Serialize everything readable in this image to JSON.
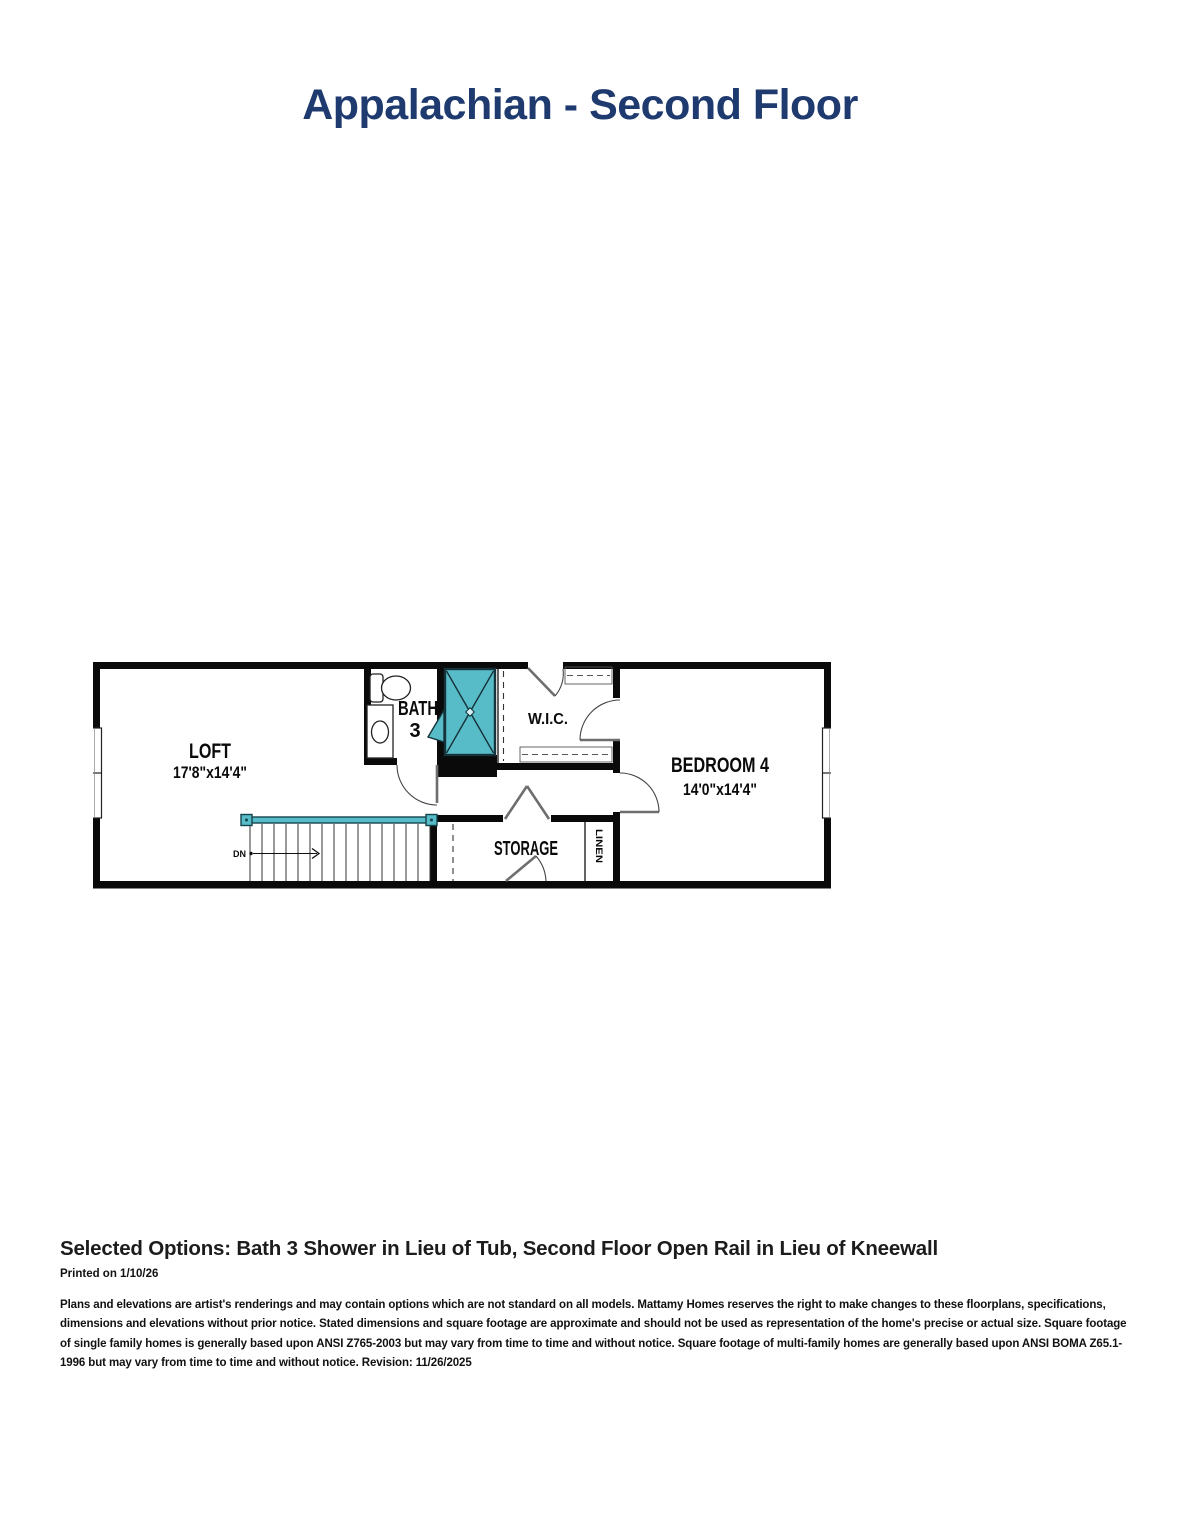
{
  "page": {
    "title": "Appalachian - Second Floor"
  },
  "plan": {
    "rooms": {
      "loft": {
        "name": "LOFT",
        "dims": "17'8\"x14'4\""
      },
      "bedroom4": {
        "name": "BEDROOM 4",
        "dims": "14'0\"x14'4\""
      },
      "bath": {
        "name": "BATH",
        "number": "3"
      },
      "wic": {
        "name": "W.I.C."
      },
      "storage": {
        "name": "STORAGE"
      },
      "linen": {
        "name": "LINEN"
      }
    },
    "stairs": {
      "direction_label": "DN"
    }
  },
  "footer": {
    "selected_options": "Selected Options: Bath 3 Shower in Lieu of Tub, Second Floor Open Rail in Lieu of Kneewall",
    "printed_on": "Printed on 1/10/26",
    "disclaimer": "Plans and elevations are artist's renderings and may contain options which are not standard on all models. Mattamy Homes reserves the right to make changes to these floorplans, specifications, dimensions and elevations without prior notice. Stated dimensions and square footage are approximate and should not be used as representation of the home's precise or actual size. Square footage of single family homes is generally based upon ANSI Z765-2003 but may vary from time to time and without notice. Square footage of multi-family homes are generally based upon ANSI BOMA Z65.1-1996 but may vary from time to time and without notice. Revision: 11/26/2025"
  },
  "colors": {
    "title_navy": "#1e3a6e",
    "fixture_teal": "#58bcc8",
    "wall_black": "#0a0a0a"
  }
}
